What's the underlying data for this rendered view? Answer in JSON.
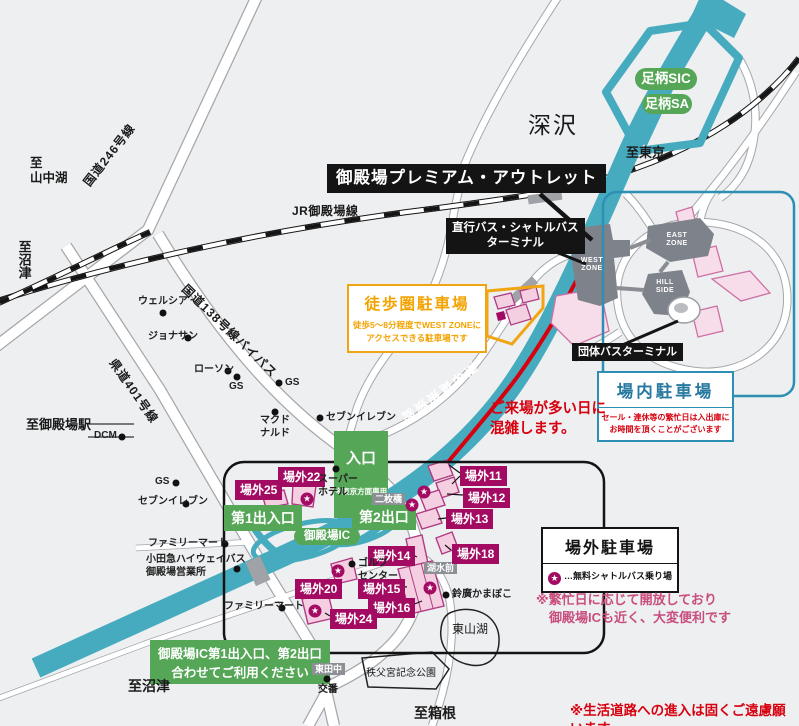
{
  "colors": {
    "highway_teal": "#47ABBF",
    "green": "#55A757",
    "magenta": "#A30B62",
    "pink_fill": "#F4CFE1",
    "red": "#D7000F",
    "pink_note": "#C94E7E",
    "blue": "#2E8FB5",
    "orange": "#F0A513",
    "building_gray": "#7E828A"
  },
  "black_labels": {
    "outlet": "御殿場プレミアム・アウトレット",
    "shuttle_terminal": "直行バス・シャトルバス\nターミナル",
    "group_bus_terminal": "団体バスターミナル"
  },
  "green_labels": {
    "ashigara_sic": "足柄SIC",
    "ashigara_sa": "足柄SA",
    "entrance": "入口",
    "entrance_note": "※東京方面専用",
    "gate1": "第1出入口",
    "gate2": "第2出口",
    "gotemba_ic": "御殿場IC",
    "ic_note": "御殿場IC第1出入口、第2出口\n合わせてご利用ください"
  },
  "boxes": {
    "walk": {
      "title": "徒歩圏駐車場",
      "body": "徒歩5〜8分程度でWEST ZONEに\nアクセスできる駐車場です"
    },
    "onsite": {
      "title": "場内駐車場",
      "body": "セール・連休等の繁忙日は入出庫に\nお時間を頂くことがございます"
    },
    "offsite": {
      "title": "場外駐車場",
      "star_glyph": "★",
      "legend": "…無料シャトルバス乗り場",
      "note": "※繁忙日に応じて開放しており\n　御殿場ICも近く、大変便利です"
    }
  },
  "notes": {
    "congestion": "ご来場が多い日に\n混雑します。",
    "local_roads": "※生活道路への進入は固くご遠慮願います"
  },
  "roads": {
    "r246": "国道246号線",
    "jr": "JR御殿場線",
    "r138bp": "国道138号線バイパス",
    "k401": "県道401号線",
    "tomei": "東名高速道路"
  },
  "directions": {
    "yamanakako": "至\n山中湖",
    "numazu_left": "至沼津",
    "tokyo": "至東京",
    "gotemba_sta": "至御殿場駅",
    "numazu_bottom": "至沼津",
    "hakone": "至箱根"
  },
  "places": {
    "fukasawa": "深沢",
    "higashiyama_lake": "東山湖",
    "chichibu_park": "秩父宮記念公園",
    "koban": "交番",
    "nimaibashi": "二枚橋",
    "kosui_mae": "湖水前",
    "higashi_tanaka": "東田中"
  },
  "zones": {
    "west": "WEST\nZONE",
    "east": "EAST\nZONE",
    "hill": "HILL\nSIDE"
  },
  "offsite_labels": [
    {
      "text": "場外25",
      "x": 235,
      "y": 480
    },
    {
      "text": "場外22",
      "x": 278,
      "y": 467
    },
    {
      "text": "場外11",
      "x": 460,
      "y": 466
    },
    {
      "text": "場外12",
      "x": 463,
      "y": 488
    },
    {
      "text": "場外13",
      "x": 446,
      "y": 509
    },
    {
      "text": "場外14",
      "x": 368,
      "y": 546
    },
    {
      "text": "場外18",
      "x": 452,
      "y": 544
    },
    {
      "text": "場外20",
      "x": 295,
      "y": 579
    },
    {
      "text": "場外15",
      "x": 358,
      "y": 579
    },
    {
      "text": "場外16",
      "x": 368,
      "y": 598
    },
    {
      "text": "場外24",
      "x": 330,
      "y": 609
    }
  ],
  "shuttle_stars": [
    {
      "x": 307,
      "y": 499
    },
    {
      "x": 424,
      "y": 492
    },
    {
      "x": 412,
      "y": 505
    },
    {
      "x": 338,
      "y": 571
    },
    {
      "x": 430,
      "y": 588
    },
    {
      "x": 315,
      "y": 611
    }
  ],
  "poi_dots": [
    {
      "x": 163,
      "y": 313
    },
    {
      "x": 188,
      "y": 338
    },
    {
      "x": 228,
      "y": 371
    },
    {
      "x": 237,
      "y": 377
    },
    {
      "x": 279,
      "y": 383
    },
    {
      "x": 275,
      "y": 412
    },
    {
      "x": 320,
      "y": 418
    },
    {
      "x": 122,
      "y": 437
    },
    {
      "x": 176,
      "y": 483
    },
    {
      "x": 186,
      "y": 504
    },
    {
      "x": 336,
      "y": 469
    },
    {
      "x": 225,
      "y": 544
    },
    {
      "x": 237,
      "y": 569
    },
    {
      "x": 282,
      "y": 608
    },
    {
      "x": 352,
      "y": 564
    },
    {
      "x": 446,
      "y": 595
    },
    {
      "x": 327,
      "y": 679
    }
  ],
  "poi_texts": [
    {
      "text": "ウェルシア",
      "x": 138,
      "y": 296
    },
    {
      "text": "ジョナサン",
      "x": 148,
      "y": 331
    },
    {
      "text": "ローソン",
      "x": 194,
      "y": 364
    },
    {
      "text": "GS",
      "x": 229,
      "y": 381
    },
    {
      "text": "GS",
      "x": 285,
      "y": 377
    },
    {
      "text": "マクド\nナルド",
      "x": 260,
      "y": 415
    },
    {
      "text": "セブンイレブン",
      "x": 326,
      "y": 412
    },
    {
      "text": "DCM",
      "x": 94,
      "y": 430
    },
    {
      "text": "GS",
      "x": 155,
      "y": 476
    },
    {
      "text": "セブンイレブン",
      "x": 138,
      "y": 496
    },
    {
      "text": "スーパー\nホテル",
      "x": 318,
      "y": 474
    },
    {
      "text": "ファミリーマート",
      "x": 148,
      "y": 538
    },
    {
      "text": "小田急ハイウェイバス\n御殿場営業所",
      "x": 146,
      "y": 554
    },
    {
      "text": "ファミリーマート",
      "x": 224,
      "y": 601
    },
    {
      "text": "ゴルフ\nセンター",
      "x": 358,
      "y": 558
    },
    {
      "text": "鈴廣かまぼこ",
      "x": 452,
      "y": 589
    },
    {
      "text": "交番",
      "x": 318,
      "y": 684
    }
  ]
}
